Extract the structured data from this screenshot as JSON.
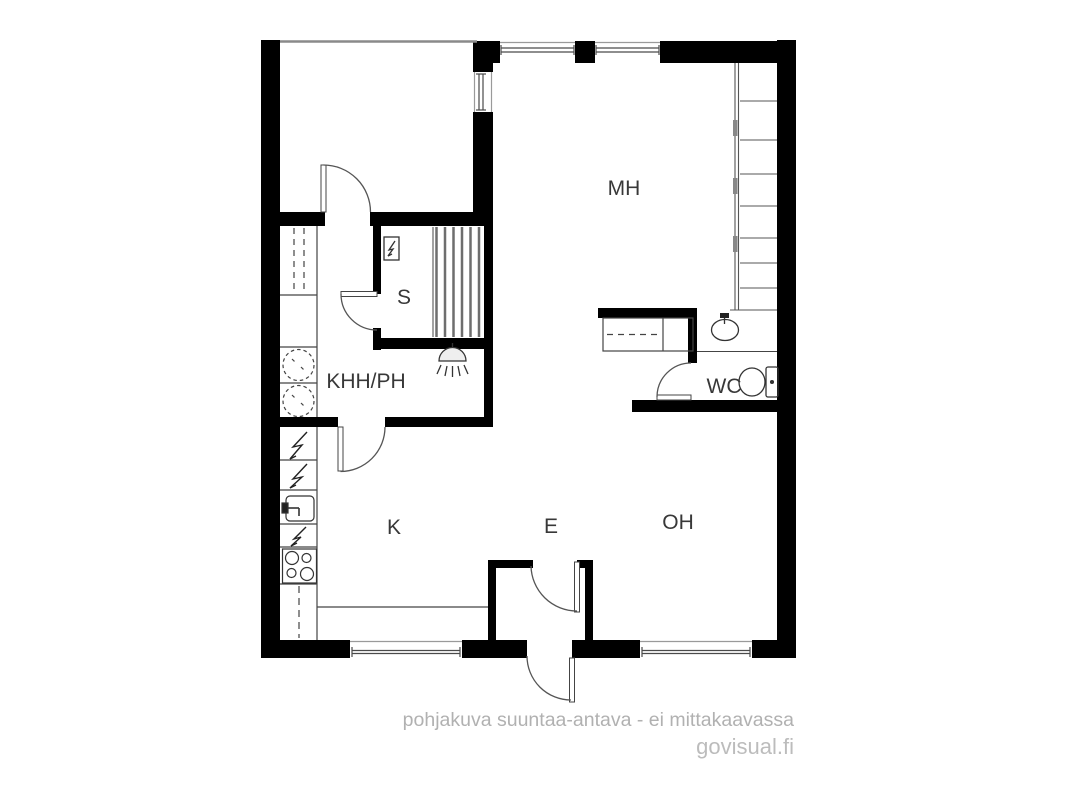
{
  "rooms": {
    "mh": {
      "label": "MH"
    },
    "s": {
      "label": "S"
    },
    "khh_ph": {
      "label": "KHH/PH"
    },
    "wc": {
      "label": "WC"
    },
    "k": {
      "label": "K"
    },
    "e": {
      "label": "E"
    },
    "oh": {
      "label": "OH"
    }
  },
  "footer": {
    "disclaimer": "pohjakuva suuntaa-antava - ei mittakaavassa",
    "brand": "govisual.fi"
  },
  "colors": {
    "wall": "#000000",
    "fixture_line": "#3d3d3d",
    "bench_line": "#6e6e6e",
    "label_text": "#383838",
    "footer_text": "#b1b1b1",
    "brand_text": "#bcbcbc",
    "background": "#ffffff"
  },
  "icons": {
    "sauna_heater_icon": "box with lightning bolt",
    "electrical_appliance_icon": "lightning bolt",
    "shower_icon": "shower head with spray",
    "washing_machine_icon": "dashed circle drum",
    "kitchen_sink_icon": "basin with tap",
    "stove_icon": "four burner circles",
    "wash_basin_icon": "oval basin with tap",
    "toilet_icon": "bowl with cistern",
    "window_icon": "double line in wall gap",
    "door_swing_icon": "quarter-circle arc"
  }
}
